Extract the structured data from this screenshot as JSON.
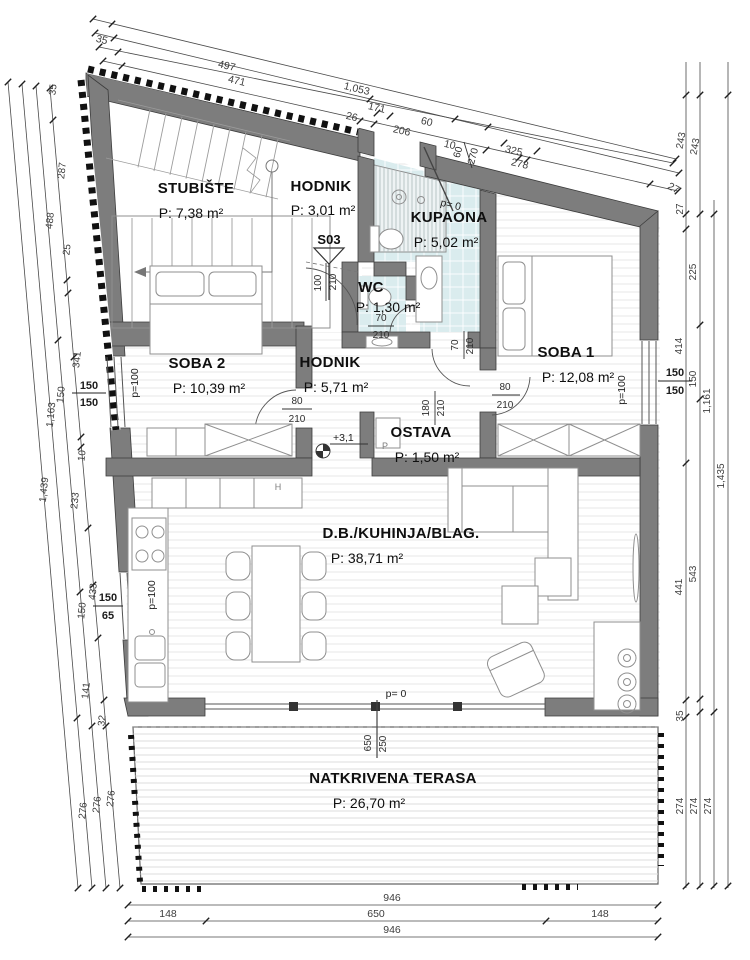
{
  "plan_title": "Stan - tlocrt",
  "rooms": [
    {
      "name": "STUBIŠTE",
      "area": "P: 7,38 m²"
    },
    {
      "name": "HODNIK",
      "area": "P: 3,01 m²"
    },
    {
      "name": "KUPAONA",
      "area": "P: 5,02 m²"
    },
    {
      "name": "WC",
      "area": "P: 1,30 m²"
    },
    {
      "name": "SOBA 2",
      "area": "P: 10,39 m²"
    },
    {
      "name": "HODNIK",
      "area": "P: 5,71 m²"
    },
    {
      "name": "SOBA 1",
      "area": "P: 12,08 m²"
    },
    {
      "name": "OSTAVA",
      "area": "P: 1,50 m²"
    },
    {
      "name": "D.B./KUHINJA/BLAG.",
      "area": "P: 38,71 m²"
    },
    {
      "name": "NATKRIVENA TERASA",
      "area": "P: 26,70 m²"
    }
  ],
  "marks": {
    "section": "S03",
    "level_living": "+3,1",
    "level_entry": "p= 0",
    "level_terrace": "p= 0",
    "parapet": "p=100",
    "appliance_h": "H",
    "appliance_p": "P"
  },
  "windows": [
    {
      "w": "150",
      "h": "150"
    },
    {
      "w": "150",
      "h": "65"
    },
    {
      "w": "150",
      "h": "150"
    }
  ],
  "doors": {
    "entry": {
      "w": "60",
      "h": "270"
    },
    "hall": {
      "w": "100",
      "h": "210"
    },
    "wc": {
      "w": "70",
      "h": "210"
    },
    "bath": {
      "w": "70",
      "h": "210"
    },
    "room2": {
      "w": "80",
      "h": "210"
    },
    "room1": {
      "w": "80",
      "h": "210"
    },
    "pantry": {
      "w": "180",
      "h": "210"
    },
    "terrace": {
      "w": "650",
      "h": "250"
    }
  },
  "dims": {
    "top": [
      "35",
      "497",
      "471",
      "1,053",
      "171",
      "26",
      "206",
      "60",
      "10",
      "325",
      "278",
      "27"
    ],
    "left": [
      "35",
      "287",
      "488",
      "25",
      "341",
      "150",
      "1,163",
      "10",
      "1,439",
      "233",
      "433",
      "150",
      "141",
      "32",
      "276",
      "276",
      "276"
    ],
    "right": [
      "243",
      "243",
      "27",
      "225",
      "414",
      "150",
      "1,161",
      "1,435",
      "543",
      "441",
      "35",
      "274",
      "274",
      "274"
    ],
    "bottom": [
      "946",
      "148",
      "650",
      "148",
      "946"
    ]
  }
}
